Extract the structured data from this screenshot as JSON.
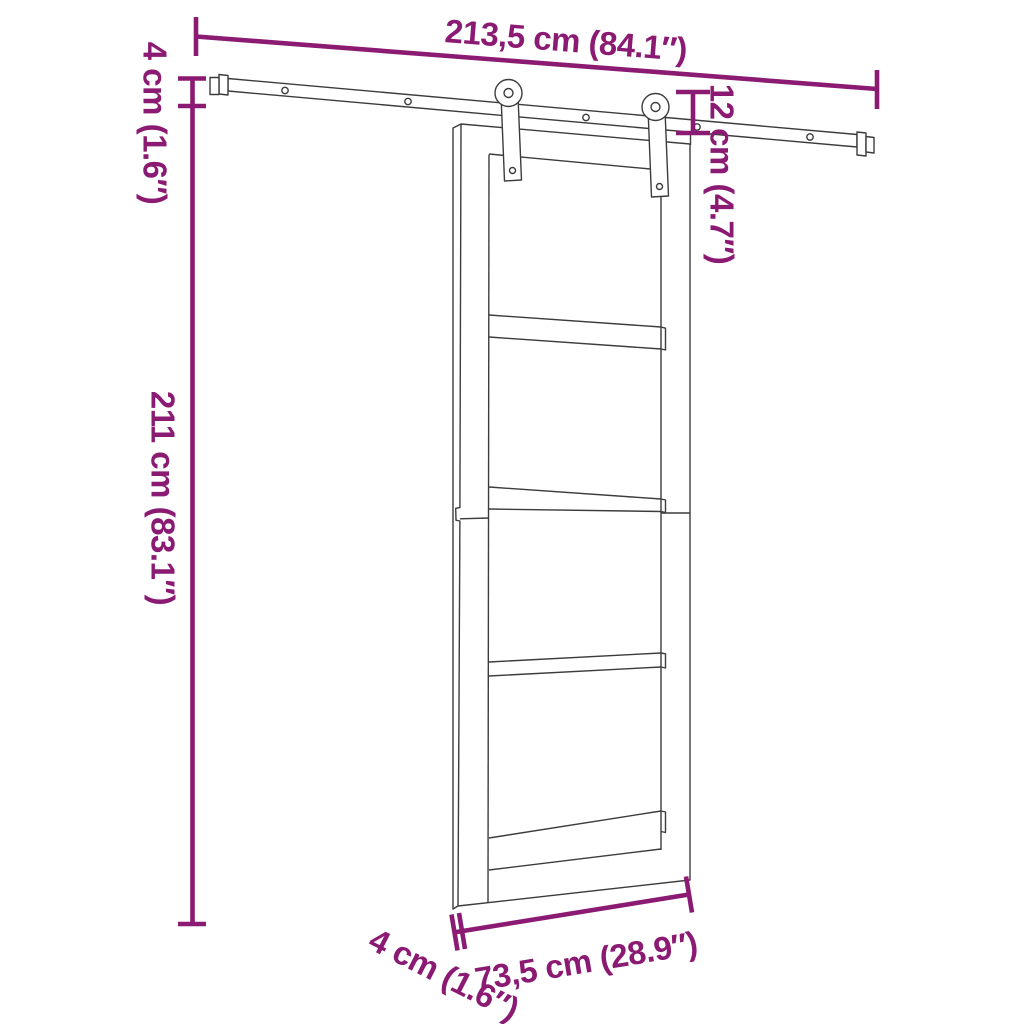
{
  "figure": {
    "kind": "product-dimension-diagram",
    "subject": "sliding-door-with-rail-hardware",
    "accent_color": "#8B1A73",
    "line_color": "#3C3C3C",
    "background_color": "#FFFFFF"
  },
  "labels": {
    "rail_length": "213,5 cm (84.1″)",
    "rail_height_left": "4 cm (1.6″)",
    "hanger_drop": "12 cm (4.7″)",
    "door_height": "211 cm (83.1″)",
    "door_width": "73,5 cm (28.9″)",
    "door_thickness": "4 cm (1.6″)"
  }
}
